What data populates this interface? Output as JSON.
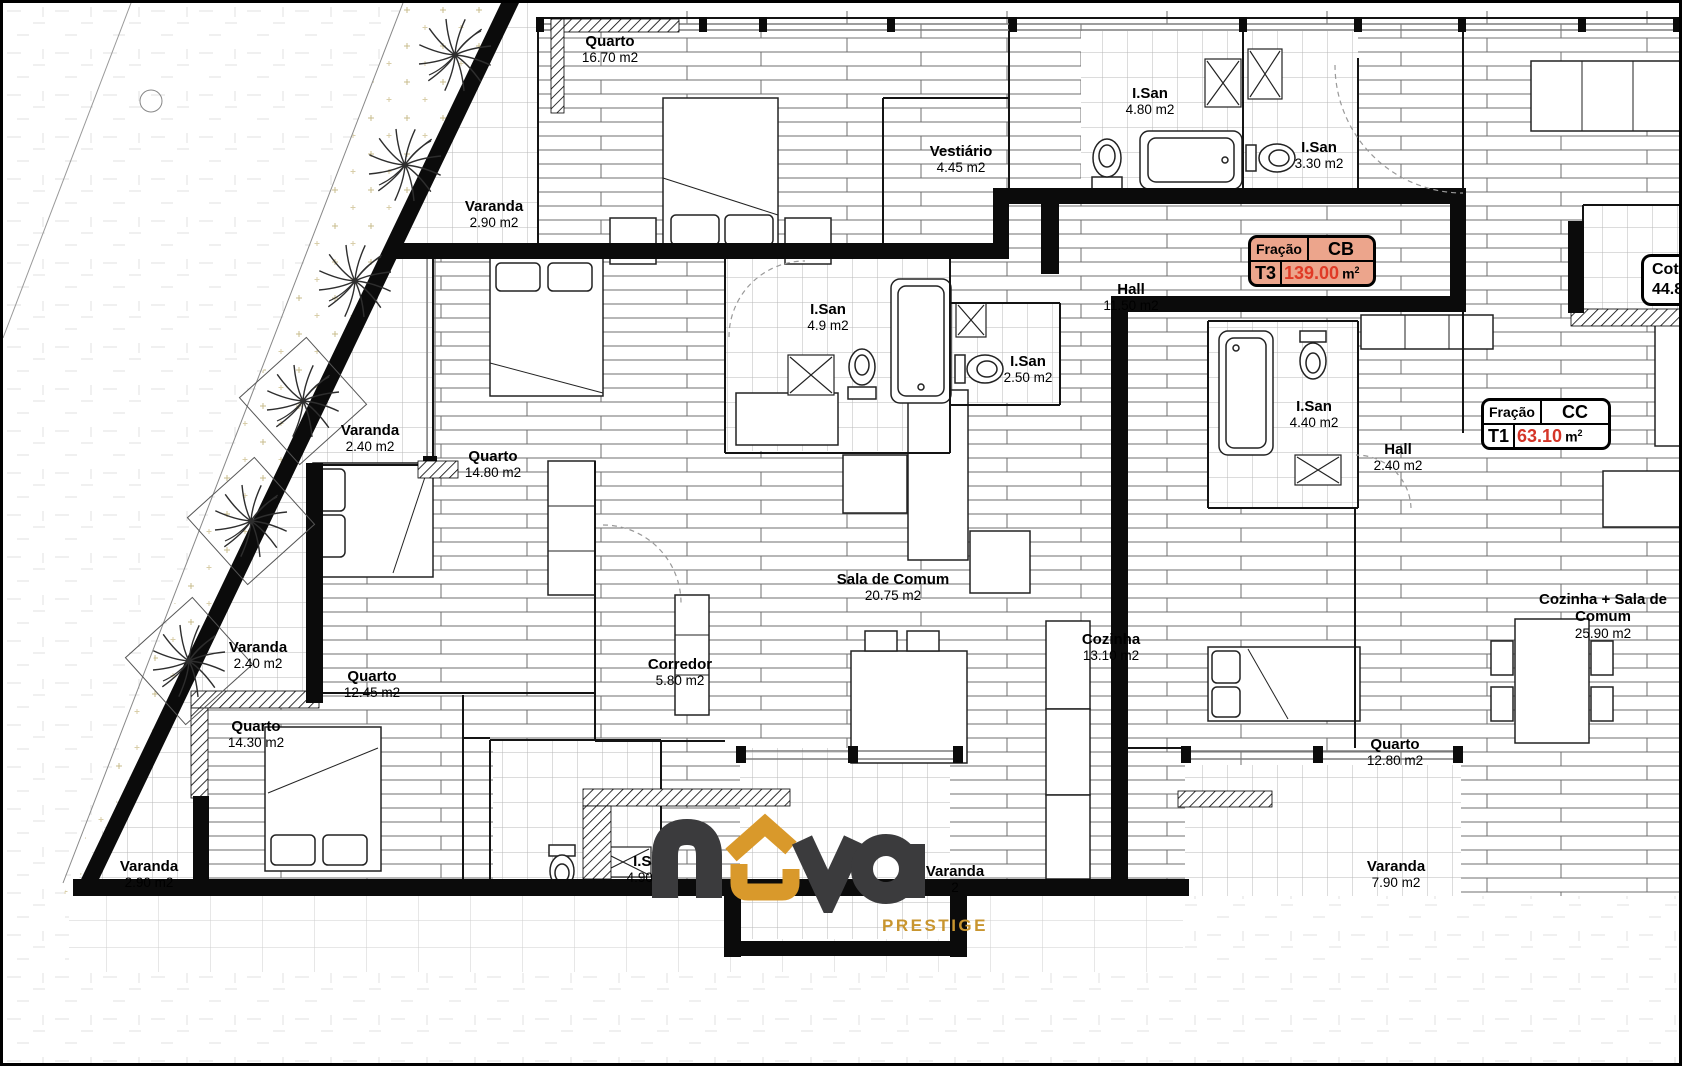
{
  "branding": {
    "logo_text": "nova",
    "tagline": "PRESTIGE",
    "logo_dark_color": "#3B3B3D",
    "logo_orange_color": "#D9992B",
    "tagline_color": "#C8952F"
  },
  "fracao_cb": {
    "label": "Fração",
    "code": "CB",
    "type": "T3",
    "value": "139.00",
    "unit": "m",
    "unit_sup": "2",
    "bg_color": "#ECA58C",
    "value_color": "#E03A26"
  },
  "fracao_cc": {
    "label": "Fração",
    "code": "CC",
    "type": "T1",
    "value": "63.10",
    "unit": "m",
    "unit_sup": "2",
    "bg_color": "#FFFFFF",
    "value_color": "#D53528"
  },
  "corner_label": {
    "line1": "Cot",
    "line2": "44.8"
  },
  "rooms": [
    {
      "name": "Quarto",
      "area": "16.70 m2"
    },
    {
      "name": "Varanda",
      "area": "2.90 m2"
    },
    {
      "name": "Vestiário",
      "area": "4.45 m2"
    },
    {
      "name": "I.San",
      "area": "4.80 m2"
    },
    {
      "name": "I.San",
      "area": "3.30 m2"
    },
    {
      "name": "Hall",
      "area": "11.50 m2"
    },
    {
      "name": "I.San",
      "area": "4.9 m2"
    },
    {
      "name": "I.San",
      "area": "2.50 m2"
    },
    {
      "name": "Varanda",
      "area": "2.40 m2"
    },
    {
      "name": "Quarto",
      "area": "14.80 m2"
    },
    {
      "name": "I.San",
      "area": "4.40 m2"
    },
    {
      "name": "Hall",
      "area": "2.40 m2"
    },
    {
      "name": "Sala de Comum",
      "area": "20.75 m2"
    },
    {
      "name": "Varanda",
      "area": "2.40 m2"
    },
    {
      "name": "Quarto",
      "area": "12.45 m2"
    },
    {
      "name": "Corredor",
      "area": "5.80 m2"
    },
    {
      "name": "Cozinha",
      "area": "13.10 m2"
    },
    {
      "name": "Cozinha + Sala de Comum",
      "area": "25.90 m2"
    },
    {
      "name": "Quarto",
      "area": "14.30 m2"
    },
    {
      "name": "Quarto",
      "area": "12.80 m2"
    },
    {
      "name": "Varanda",
      "area": "2.90 m2"
    },
    {
      "name": "I.San",
      "area": "4.90 m2"
    },
    {
      "name": "Varanda",
      "area": "2"
    },
    {
      "name": "Varanda",
      "area": "7.90 m2"
    }
  ]
}
